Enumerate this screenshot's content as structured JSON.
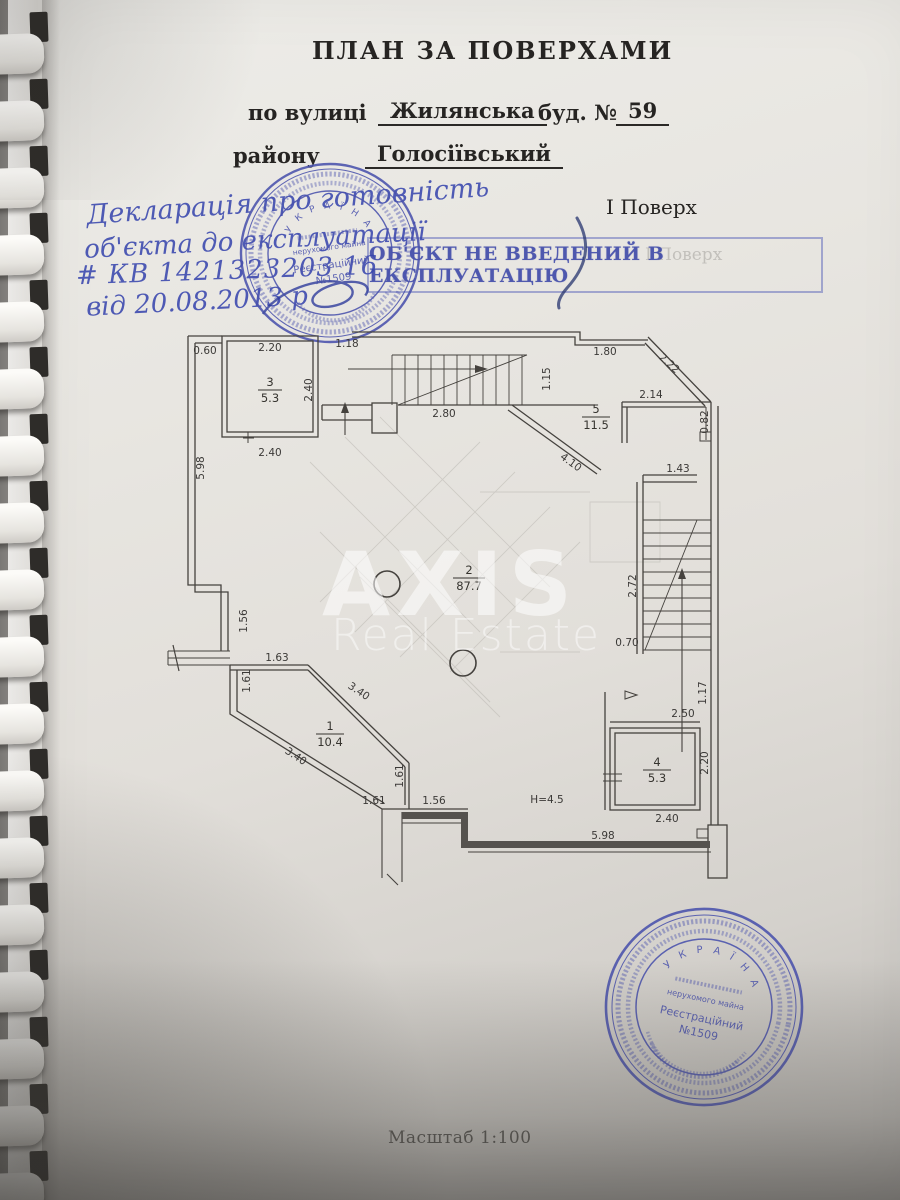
{
  "header": {
    "title": "ПЛАН ЗА ПОВЕРХАМИ",
    "street_label": "по вулиці",
    "street_value": "Жилянська",
    "building_label": "буд. №",
    "building_value": "59",
    "district_label": "району",
    "district_value": "Голосіївський",
    "floor": "І Поверх"
  },
  "handwriting": {
    "line1": "Декларація про готовність",
    "line2": "об'єкта до експлуатації",
    "line3": "# КВ 1421323203 16",
    "line4": "від 20.08.2013 р"
  },
  "status_stamp": {
    "text": "ОБ'ЄКТ  НЕ ВВЕДЕНИЙ В ЕКСПЛУАТАЦІЮ"
  },
  "round_stamp": {
    "country": "У К Р А Ї Н А",
    "line_small": "нерухомого майна",
    "reg_label": "Реєстраційний",
    "reg_number": "№1509"
  },
  "watermark": {
    "line1": "AXIS",
    "line2": "Real Estate"
  },
  "colors": {
    "stamp_blue": "#4a52ad",
    "pen_blue": "#3846ad"
  },
  "plan": {
    "rooms": [
      {
        "num": "3",
        "area": "5.3"
      },
      {
        "num": "5",
        "area": "11.5"
      },
      {
        "num": "2",
        "area": "87.7"
      },
      {
        "num": "1",
        "area": "10.4"
      },
      {
        "num": "4",
        "area": "5.3"
      }
    ],
    "height_note": "Н=4.5",
    "dims": [
      {
        "t": "0.60"
      },
      {
        "t": "2.20"
      },
      {
        "t": "1.18"
      },
      {
        "t": "1.80"
      },
      {
        "t": "2.40"
      },
      {
        "t": "2.40"
      },
      {
        "t": "5.98"
      },
      {
        "t": "1.15"
      },
      {
        "t": "2.22"
      },
      {
        "t": "2.14"
      },
      {
        "t": "0.82"
      },
      {
        "t": "2.80"
      },
      {
        "t": "4.10"
      },
      {
        "t": "1.43"
      },
      {
        "t": "2.72"
      },
      {
        "t": "0.70"
      },
      {
        "t": "1.56"
      },
      {
        "t": "1.63"
      },
      {
        "t": "1.61"
      },
      {
        "t": "3.40"
      },
      {
        "t": "3.40"
      },
      {
        "t": "1.61"
      },
      {
        "t": "1.61"
      },
      {
        "t": "1.56"
      },
      {
        "t": "5.98"
      },
      {
        "t": "2.50"
      },
      {
        "t": "1.17"
      },
      {
        "t": "2.20"
      },
      {
        "t": "2.40"
      }
    ]
  },
  "footer": {
    "scale": "Масштаб 1:100"
  }
}
